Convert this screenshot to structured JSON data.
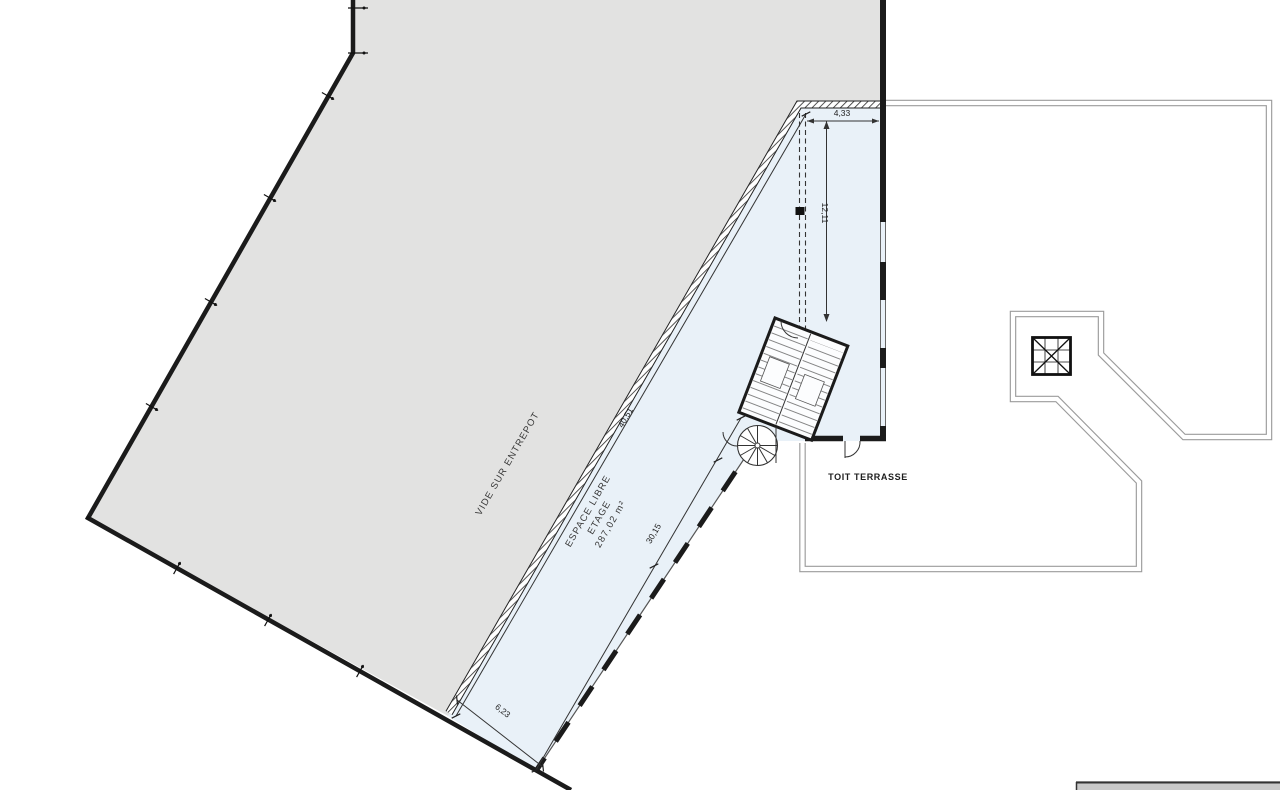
{
  "drawing": {
    "rooms": {
      "warehouse_void": "VIDE SUR ENTREPOT",
      "free_space_line1": "ESPACE LIBRE",
      "free_space_line2": "ETAGE",
      "free_space_area": "287,02 m²",
      "roof_terrace": "TOIT TERRASSE"
    },
    "dimensions": {
      "bay_width": "4,33",
      "bay_depth": "12,11",
      "warehouse_long_edge": "40,51",
      "free_space_length": "30,15",
      "free_space_width": "6,23"
    },
    "colors": {
      "warehouse_fill": "#e2e2e1",
      "free_space_fill": "#e9f1f8",
      "wall": "#1b1b1b",
      "terrace_line": "#9b9b9b",
      "titleblock_fill": "#c9c9c9"
    }
  }
}
